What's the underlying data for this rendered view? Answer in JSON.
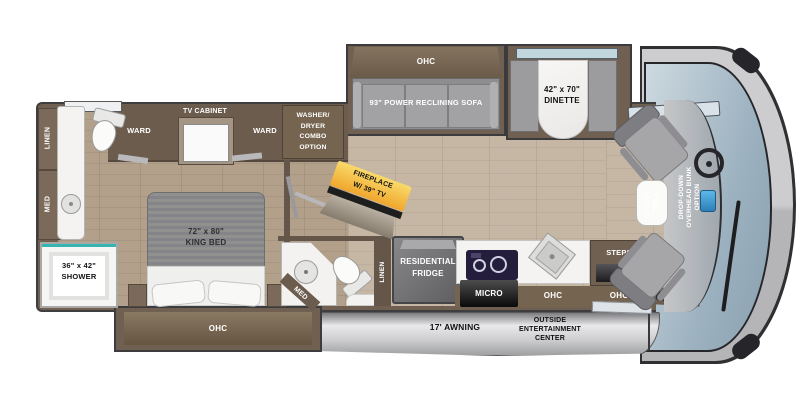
{
  "plan": {
    "sofa_ohc": "OHC",
    "sofa": "93\" POWER RECLINING SOFA",
    "dinette_size": "42\" x 70\"",
    "dinette": "DINETTE",
    "ward_left": "WARD",
    "tv_cabinet": "TV CABINET",
    "ward_right": "WARD",
    "washer_dryer": [
      "WASHER/",
      "DRYER",
      "COMBO",
      "OPTION"
    ],
    "linen_rear": "LINEN",
    "med_rear": "MED",
    "shower_size": "36\" x 42\"",
    "shower": "SHOWER",
    "bed_size": "72\" x 80\"",
    "bed": "KING BED",
    "bed_ohc": "OHC",
    "fireplace": [
      "FIREPLACE",
      "W/ 39\" TV"
    ],
    "med_mid": "MED",
    "linen_mid": "LINEN",
    "fridge": [
      "RESIDENTIAL",
      "FRIDGE"
    ],
    "micro": "MICRO",
    "kitchen_ohc": "OHC",
    "steps": "STEPS",
    "entry_ohc": "OHC",
    "cockpit_table": [
      "COCKPIT",
      "TABLE"
    ],
    "bunk": [
      "DROP-DOWN",
      "OVERHEAD BUNK",
      "OPTION"
    ],
    "awning": "17' AWNING",
    "outside_center": [
      "OUTSIDE",
      "ENTERTAINMENT",
      "CENTER"
    ]
  },
  "colors": {
    "wall_brown": "#6f6052",
    "cabinet_brown": "#7b6a59",
    "floor_tan": "#c6b7a4",
    "accent_teal": "#35b4b2",
    "fireplace_yellow": "#f0a62c",
    "windshield_blue": "#9db2c0",
    "seat_gray": "#9c9c9e"
  }
}
